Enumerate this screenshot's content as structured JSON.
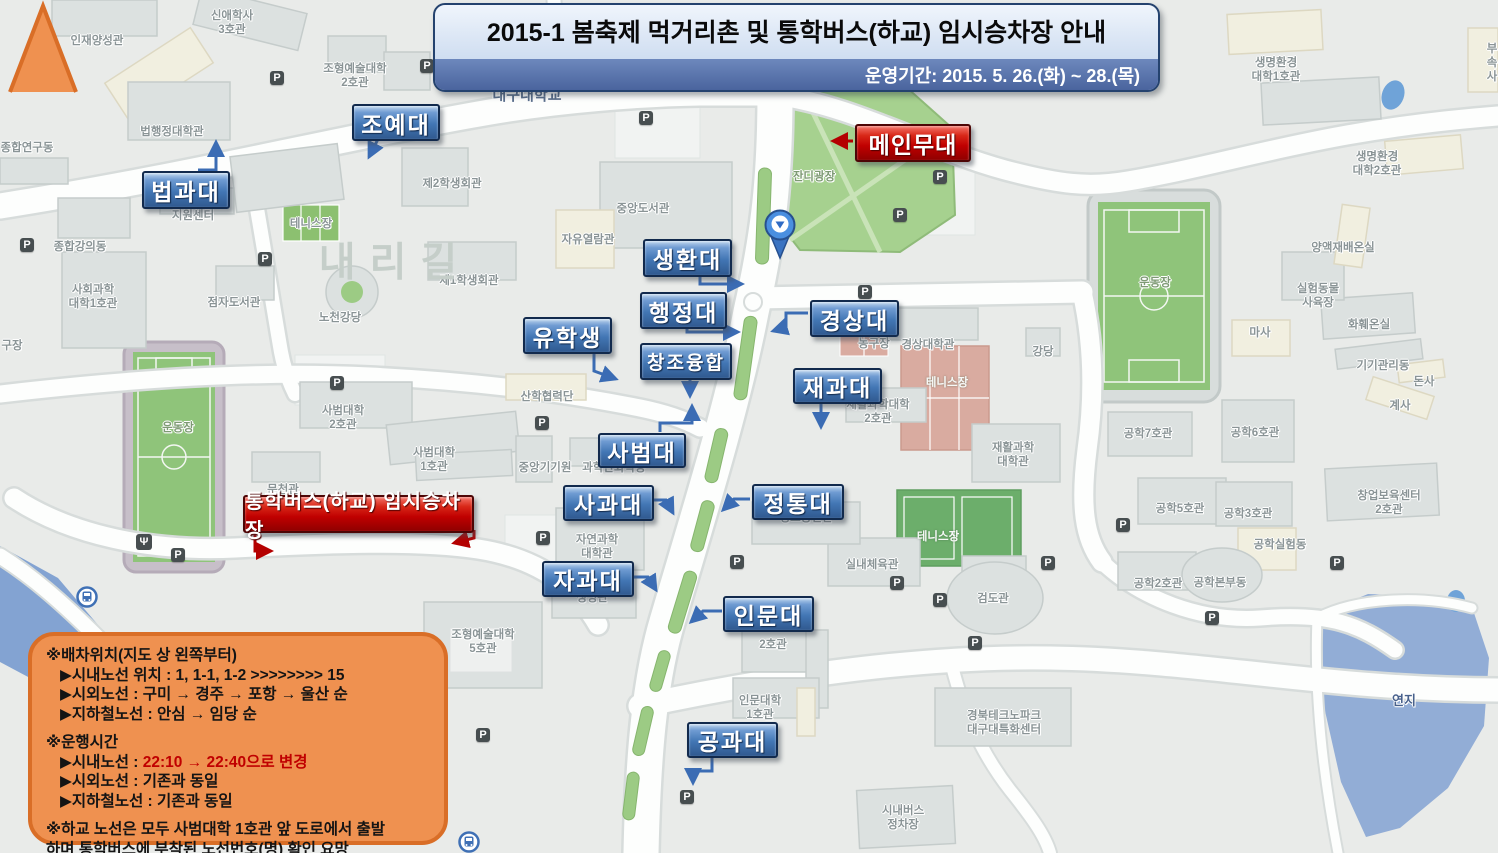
{
  "banner": {
    "title": "2015-1 봄축제 먹거리촌 및 통학버스(하교) 임시승차장 안내",
    "subtitle": "운영기간: 2015. 5. 26.(화) ~ 28.(목)"
  },
  "colors": {
    "college_label_blue": "#4276b4",
    "label_border_navy": "#122a4d",
    "highlight_red": "#c00000",
    "banner_band_blue": "#4a649e",
    "bubble_orange": "#ef9150",
    "bubble_border_orange": "#d96e27",
    "grass_green": "#9ccb84",
    "pond_blue": "#92add6",
    "map_background": "#e9ebe9"
  },
  "stage_label": {
    "text": "메인무대"
  },
  "bus_label": {
    "text": "통학버스(하교) 임시승차장"
  },
  "colleges": [
    {
      "id": "joyedae",
      "text": "조예대",
      "x": 352,
      "y": 104,
      "w": 84,
      "h": 33
    },
    {
      "id": "beopgwadae",
      "text": "법과대",
      "x": 142,
      "y": 171,
      "w": 84,
      "h": 34
    },
    {
      "id": "saenghwandae",
      "text": "생환대",
      "x": 643,
      "y": 239,
      "w": 85,
      "h": 34
    },
    {
      "id": "haengjeongdae",
      "text": "행정대",
      "x": 640,
      "y": 292,
      "w": 83,
      "h": 33
    },
    {
      "id": "yuhaksaeng",
      "text": "유학생",
      "x": 523,
      "y": 317,
      "w": 85,
      "h": 33
    },
    {
      "id": "changjoyunghap",
      "text": "창조융합",
      "x": 640,
      "y": 343,
      "w": 88,
      "h": 33,
      "fs": 19
    },
    {
      "id": "gyeongsangdae",
      "text": "경상대",
      "x": 810,
      "y": 300,
      "w": 85,
      "h": 33
    },
    {
      "id": "jaegwadae",
      "text": "재과대",
      "x": 793,
      "y": 368,
      "w": 85,
      "h": 32
    },
    {
      "id": "sabeomdae",
      "text": "사범대",
      "x": 598,
      "y": 433,
      "w": 84,
      "h": 31
    },
    {
      "id": "sagwadae",
      "text": "사과대",
      "x": 563,
      "y": 485,
      "w": 87,
      "h": 32
    },
    {
      "id": "jeongtongdae",
      "text": "정통대",
      "x": 752,
      "y": 484,
      "w": 88,
      "h": 32
    },
    {
      "id": "jagwadae",
      "text": "자과대",
      "x": 542,
      "y": 561,
      "w": 88,
      "h": 32
    },
    {
      "id": "inmundae",
      "text": "인문대",
      "x": 723,
      "y": 596,
      "w": 87,
      "h": 32
    },
    {
      "id": "gonggwadae",
      "text": "공과대",
      "x": 687,
      "y": 722,
      "w": 87,
      "h": 32
    }
  ],
  "notice": {
    "lines": [
      {
        "gap": 0,
        "indent": 0,
        "parts": [
          {
            "t": "※배차위치(지도 상 왼쪽부터)"
          }
        ]
      },
      {
        "gap": 0,
        "indent": 1,
        "parts": [
          {
            "t": "▶시내노선 위치 : 1, 1-1, 1-2 >>>>>>>> 15"
          }
        ]
      },
      {
        "gap": 0,
        "indent": 1,
        "parts": [
          {
            "t": "▶시외노선 : 구미 → 경주 → 포항 → 울산 순"
          }
        ]
      },
      {
        "gap": 0,
        "indent": 1,
        "parts": [
          {
            "t": "▶지하철노선 : 안심 → 임당 순"
          }
        ]
      },
      {
        "gap": 9,
        "indent": 0,
        "parts": [
          {
            "t": "※운행시간"
          }
        ]
      },
      {
        "gap": 0,
        "indent": 1,
        "parts": [
          {
            "t": "▶시내노선 : "
          },
          {
            "t": "22:10 → 22:40으로 변경",
            "red": true
          }
        ]
      },
      {
        "gap": 0,
        "indent": 1,
        "parts": [
          {
            "t": "▶시외노선 : 기존과 동일"
          }
        ]
      },
      {
        "gap": 0,
        "indent": 1,
        "parts": [
          {
            "t": "▶지하철노선 : 기존과 동일"
          }
        ]
      },
      {
        "gap": 9,
        "indent": 0,
        "parts": [
          {
            "t": "※하교 노선은 모두 사범대학 1호관 앞 도로에서 출발"
          }
        ]
      },
      {
        "gap": 0,
        "indent": 0,
        "parts": [
          {
            "t": " 하며 통학버스에 부착된 노선번호(명) 확인 요망"
          }
        ]
      }
    ]
  },
  "map_labels": [
    {
      "t": "인재양성관",
      "x": 97,
      "y": 41
    },
    {
      "t": "신애학사\n3호관",
      "x": 232,
      "y": 23
    },
    {
      "t": "조형예술대학\n2호관",
      "x": 355,
      "y": 76
    },
    {
      "t": "법행정대학관",
      "x": 172,
      "y": 132
    },
    {
      "t": "종합연구동",
      "x": 27,
      "y": 148
    },
    {
      "t": "대구대학교",
      "x": 527,
      "y": 96,
      "c": "#5a6f8c",
      "fs": 15
    },
    {
      "t": "지원센터",
      "x": 193,
      "y": 216
    },
    {
      "t": "종합강의동",
      "x": 80,
      "y": 247
    },
    {
      "t": "사회과학\n대학1호관",
      "x": 93,
      "y": 297
    },
    {
      "t": "테니스장",
      "x": 311,
      "y": 224
    },
    {
      "t": "점자도서관",
      "x": 234,
      "y": 303
    },
    {
      "t": "노천강당",
      "x": 340,
      "y": 318
    },
    {
      "t": "제1학생회관",
      "x": 469,
      "y": 281
    },
    {
      "t": "제2학생회관",
      "x": 452,
      "y": 184
    },
    {
      "t": "중앙도서관",
      "x": 643,
      "y": 209
    },
    {
      "t": "자유열람관",
      "x": 588,
      "y": 240
    },
    {
      "t": "잔디광장",
      "x": 814,
      "y": 177,
      "c": "#7e9a74"
    },
    {
      "t": "운동장",
      "x": 1155,
      "y": 283,
      "c": "#7e9a74"
    },
    {
      "t": "운동장",
      "x": 178,
      "y": 428,
      "c": "#7e9a74"
    },
    {
      "t": "구장",
      "x": 12,
      "y": 346
    },
    {
      "t": "농구장",
      "x": 874,
      "y": 344
    },
    {
      "t": "경상대학관",
      "x": 928,
      "y": 345
    },
    {
      "t": "강당",
      "x": 1043,
      "y": 352
    },
    {
      "t": "테니스장",
      "x": 947,
      "y": 383,
      "w": 1
    },
    {
      "t": "재활과학대학\n2호관",
      "x": 878,
      "y": 412
    },
    {
      "t": "재활과학\n대학관",
      "x": 1013,
      "y": 455
    },
    {
      "t": "사범대학\n2호관",
      "x": 343,
      "y": 418
    },
    {
      "t": "사범대학\n1호관",
      "x": 434,
      "y": 460
    },
    {
      "t": "중앙기기원",
      "x": 545,
      "y": 468
    },
    {
      "t": "과학관화학동",
      "x": 614,
      "y": 468
    },
    {
      "t": "문천관",
      "x": 283,
      "y": 490
    },
    {
      "t": "산학협력단",
      "x": 547,
      "y": 397
    },
    {
      "t": "자연과학\n대학관",
      "x": 597,
      "y": 547
    },
    {
      "t": "생명관",
      "x": 592,
      "y": 598
    },
    {
      "t": "정보통신관",
      "x": 806,
      "y": 518
    },
    {
      "t": "실내체육관",
      "x": 872,
      "y": 565
    },
    {
      "t": "테니스장",
      "x": 938,
      "y": 537,
      "w": 1
    },
    {
      "t": "검도관",
      "x": 993,
      "y": 599
    },
    {
      "t": "경북테크노파크\n대구대특화센터",
      "x": 1004,
      "y": 723
    },
    {
      "t": "공학7호관",
      "x": 1148,
      "y": 434
    },
    {
      "t": "공학6호관",
      "x": 1255,
      "y": 433
    },
    {
      "t": "공학5호관",
      "x": 1180,
      "y": 509
    },
    {
      "t": "공학3호관",
      "x": 1248,
      "y": 514
    },
    {
      "t": "공학실험동",
      "x": 1280,
      "y": 545
    },
    {
      "t": "창업보육센터\n2호관",
      "x": 1389,
      "y": 503
    },
    {
      "t": "공학2호관",
      "x": 1158,
      "y": 584
    },
    {
      "t": "공학본부동",
      "x": 1220,
      "y": 583
    },
    {
      "t": "계사",
      "x": 1400,
      "y": 406
    },
    {
      "t": "기기관리동",
      "x": 1383,
      "y": 366
    },
    {
      "t": "돈사",
      "x": 1424,
      "y": 382
    },
    {
      "t": "화훼온실",
      "x": 1369,
      "y": 325
    },
    {
      "t": "실험동물\n사육장",
      "x": 1318,
      "y": 296
    },
    {
      "t": "마사",
      "x": 1260,
      "y": 333
    },
    {
      "t": "양액재배온실",
      "x": 1343,
      "y": 248
    },
    {
      "t": "생명환경\n대학1호관",
      "x": 1276,
      "y": 70
    },
    {
      "t": "생명환경\n대학2호관",
      "x": 1377,
      "y": 164
    },
    {
      "t": "부속\n사",
      "x": 1492,
      "y": 63
    },
    {
      "t": "연지",
      "x": 1404,
      "y": 701,
      "c": "#48618c",
      "fs": 13
    },
    {
      "t": "시내버스\n정차장",
      "x": 903,
      "y": 818
    },
    {
      "t": "인문대학\n1호관",
      "x": 760,
      "y": 708
    },
    {
      "t": "2호관",
      "x": 773,
      "y": 645
    },
    {
      "t": "조형예술대학\n5호관",
      "x": 483,
      "y": 642
    },
    {
      "t": "내리길",
      "x": 395,
      "y": 263,
      "c": "#c5cec9",
      "fs": 40,
      "big": 1
    }
  ],
  "parking_glyph": "P",
  "parking_positions": [
    [
      277,
      78
    ],
    [
      427,
      66
    ],
    [
      646,
      118
    ],
    [
      940,
      177
    ],
    [
      900,
      215
    ],
    [
      27,
      245
    ],
    [
      265,
      259
    ],
    [
      865,
      292
    ],
    [
      337,
      383
    ],
    [
      542,
      423
    ],
    [
      178,
      555
    ],
    [
      543,
      538
    ],
    [
      737,
      562
    ],
    [
      897,
      583
    ],
    [
      1048,
      563
    ],
    [
      940,
      600
    ],
    [
      975,
      643
    ],
    [
      1212,
      618
    ],
    [
      1123,
      525
    ],
    [
      1337,
      563
    ],
    [
      687,
      797
    ],
    [
      483,
      735
    ]
  ],
  "bus_stop_positions": [
    [
      76,
      586
    ],
    [
      458,
      831
    ]
  ],
  "poi": {
    "restaurant": {
      "x": 144,
      "y": 542,
      "glyph": "Ψ"
    }
  }
}
